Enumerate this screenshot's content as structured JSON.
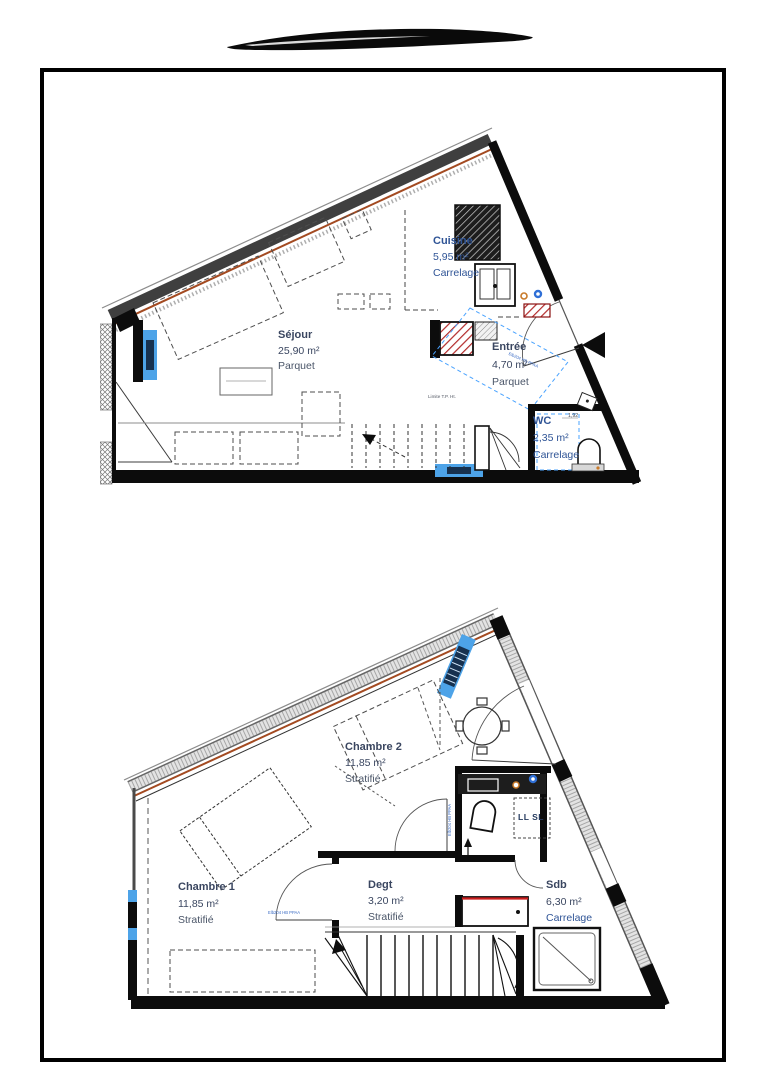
{
  "decoration": {
    "ink_stroke": "hand-drawn black marker swoosh"
  },
  "plans": {
    "upper": {
      "level": "upper floor plan",
      "rooms": {
        "cuisine": {
          "name": "Cuisine",
          "area": "5,95 m²",
          "floor": "Carrelage"
        },
        "sejour": {
          "name": "Séjour",
          "area": "25,90 m²",
          "floor": "Parquet"
        },
        "entree": {
          "name": "Entrée",
          "area": "4,70 m²",
          "floor": "Parquet"
        },
        "wc": {
          "name": "WC",
          "area": "2,35 m²",
          "floor": "Carrelage"
        }
      },
      "annotations": {
        "limite": "Limite T.P. Ht.",
        "wc_dim": "1,92",
        "wall_label": "Elb204 HB PPAA"
      }
    },
    "lower": {
      "level": "lower floor plan",
      "rooms": {
        "chambre2": {
          "name": "Chambre 2",
          "area": "11,85 m²",
          "floor": "Stratifié"
        },
        "chambre1": {
          "name": "Chambre 1",
          "area": "11,85 m²",
          "floor": "Stratifié"
        },
        "degt": {
          "name": "Degt",
          "area": "3,20 m²",
          "floor": "Stratifié"
        },
        "sdb": {
          "name": "Sdb",
          "area": "6,30 m²",
          "floor": "Carrelage"
        }
      },
      "annotations": {
        "appliances": "LL SL",
        "door_label": "Elb204 HB PPAA"
      }
    }
  },
  "colors": {
    "frame_border": "#000000",
    "wall_black": "#0c0c0c",
    "sloped_wall_gray": "#3f3f3f",
    "insulation_orange": "#a34a21",
    "window_blue": "#4da3e8",
    "window_slat_navy": "#17314f",
    "fixture_red": "#cc1f1f",
    "burner_orange": "#c87a2a",
    "burner_blue": "#2f6fd6",
    "zone_dash_blue": "#4aa3ff",
    "label_blue": "#2f5496",
    "label_dark": "#3a4660"
  }
}
